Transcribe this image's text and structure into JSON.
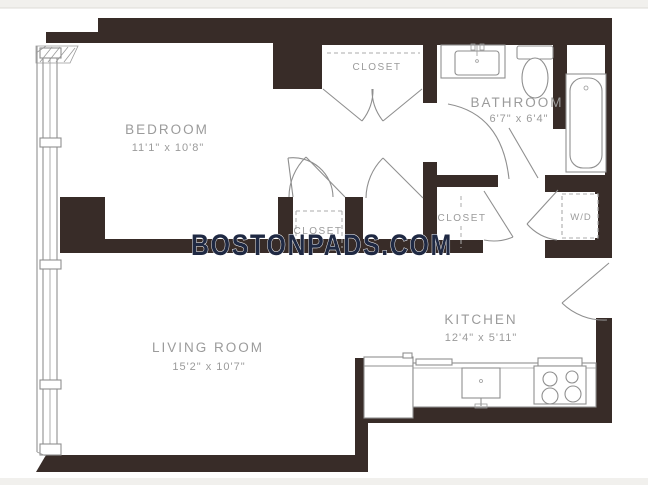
{
  "watermark": "BOSTONPADS.COM",
  "rooms": {
    "bedroom": {
      "name": "BEDROOM",
      "dims": "11'1\" x 10'8\""
    },
    "bathroom": {
      "name": "BATHROOM",
      "dims": "6'7\" x 6'4\""
    },
    "living_room": {
      "name": "LIVING ROOM",
      "dims": "15'2\" x 10'7\""
    },
    "kitchen": {
      "name": "KITCHEN",
      "dims": "12'4\" x 5'11\""
    }
  },
  "labels": {
    "closet_top": "CLOSET",
    "closet_bedroom": "CLOSET",
    "closet_hall": "CLOSET",
    "washer_dryer": "W/D"
  },
  "colors": {
    "wall": "#382c28",
    "fixture_line": "#8f8f8f",
    "label_text": "#9b9b9b",
    "watermark_text": "#1f2943",
    "floor": "#ffffff",
    "background": "#f1f0ed"
  }
}
